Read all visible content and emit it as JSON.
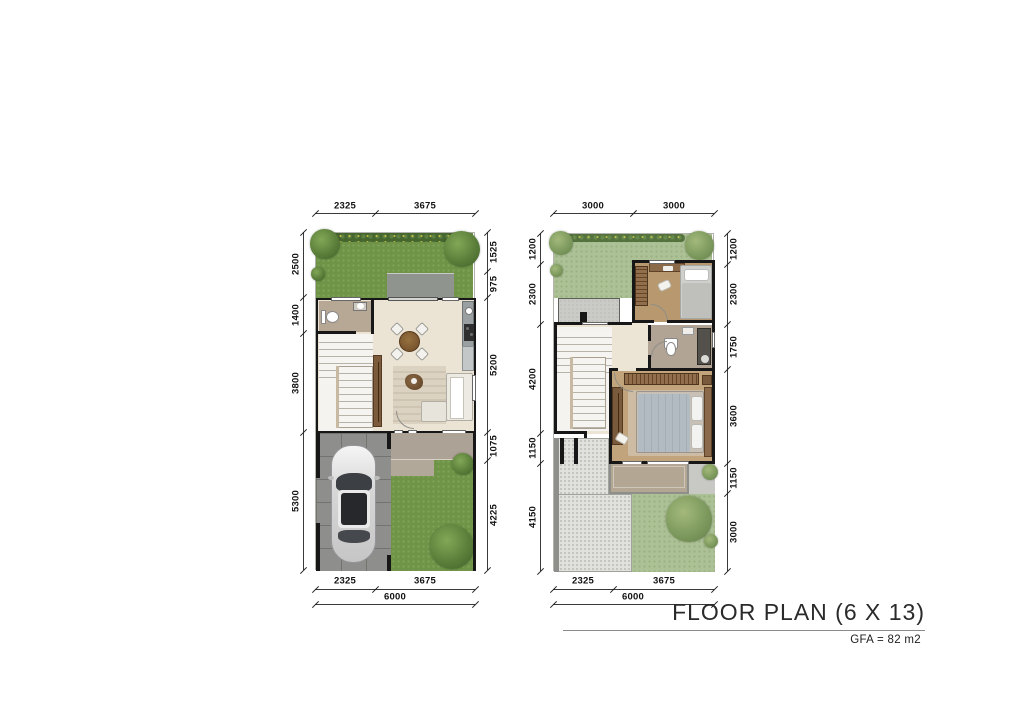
{
  "title": {
    "main": "FLOOR PLAN (6 X 13)",
    "sub": "GFA = 82 m2"
  },
  "dimensions": {
    "ground_floor": {
      "top": [
        "2325",
        "3675"
      ],
      "left": [
        "2500",
        "1400",
        "3800",
        "5300"
      ],
      "right": [
        "1525",
        "975",
        "5200",
        "1075",
        "4225"
      ],
      "bottom": [
        "2325",
        "3675"
      ],
      "overall_width": "6000"
    },
    "upper_floor": {
      "top": [
        "3000",
        "3000"
      ],
      "left": [
        "1200",
        "2300",
        "4200",
        "1150",
        "4150"
      ],
      "right": [
        "1200",
        "2300",
        "1750",
        "3600",
        "1150",
        "3000"
      ],
      "bottom": [
        "2325",
        "3675"
      ],
      "overall_width": "6000"
    }
  },
  "palette": {
    "wall": "#171717",
    "grass_ground_floor": "#6f9447",
    "grass_upper_floor": "#adc196",
    "interior_floor": "#ebe3d4",
    "wood_floor": "#bf9d74",
    "carport_pavers": "#8e8e8c",
    "roof_deck": "#e1e1dd",
    "terrace_gray": "#90948e",
    "dimension_text": "#111111"
  }
}
